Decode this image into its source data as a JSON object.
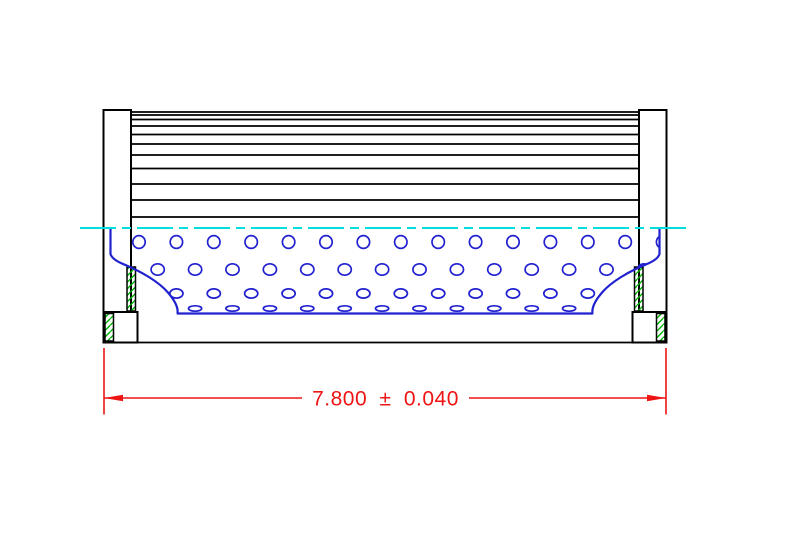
{
  "dimension": {
    "label": "7.800 ± 0.040"
  },
  "colors": {
    "background": "#ffffff",
    "black": "#000000",
    "blue": "#2121d0",
    "cyan": "#00dfdf",
    "green": "#00b400",
    "red": "#ee1414"
  },
  "drawing": {
    "pleats": {
      "x1": 131,
      "x2": 639,
      "lines_y": [
        112,
        115,
        119.5,
        126,
        134.5,
        144,
        155,
        168.5,
        184,
        200,
        217
      ]
    },
    "centerline": {
      "y": 228,
      "x1": 80,
      "x2": 686
    },
    "perforations": {
      "rows": [
        {
          "y": 242,
          "rx": 6.2,
          "ry": 6.4,
          "x_start": 139,
          "x_step": 37.4,
          "count": 15
        },
        {
          "y": 269.5,
          "rx": 6.6,
          "ry": 5.7,
          "x_start": 157.7,
          "x_step": 37.4,
          "count": 14
        },
        {
          "y": 293.5,
          "rx": 6.6,
          "ry": 4.6,
          "x_start": 139,
          "x_step": 37.4,
          "count": 15
        },
        {
          "y": 308.5,
          "rx": 6.6,
          "ry": 2.7,
          "x_start": 157.7,
          "x_step": 37.4,
          "count": 14
        }
      ]
    }
  }
}
